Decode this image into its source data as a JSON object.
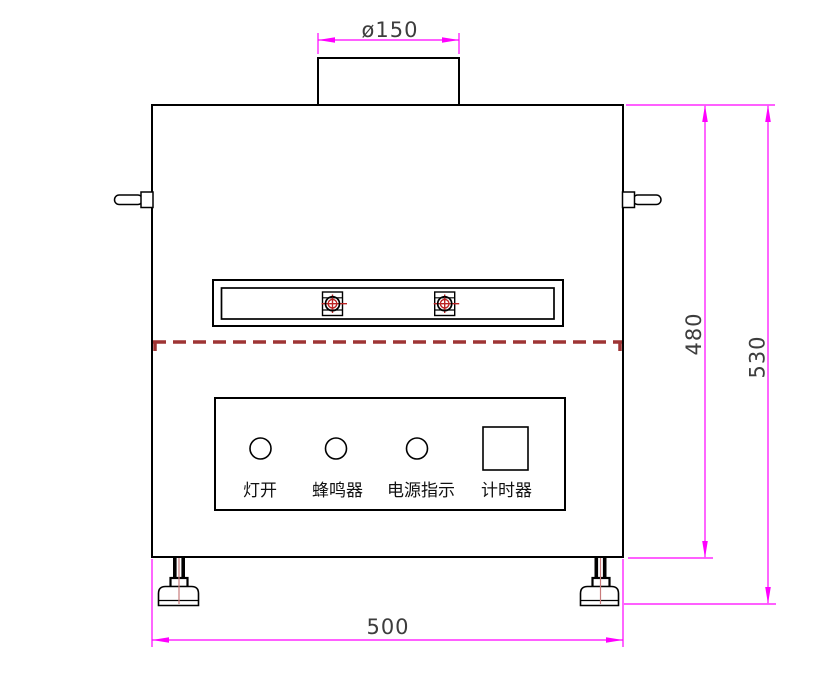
{
  "drawing": {
    "type": "engineering-front-view",
    "dimensions": {
      "vent_diameter": "ø150",
      "body_height": "480",
      "overall_height": "530",
      "body_width": "500"
    },
    "control_panel": {
      "controls": [
        {
          "shape": "circle",
          "label": "灯开"
        },
        {
          "shape": "circle",
          "label": "蜂鸣器"
        },
        {
          "shape": "circle",
          "label": "电源指示"
        },
        {
          "shape": "square",
          "label": "计时器"
        }
      ]
    },
    "colors": {
      "outline": "#000000",
      "dimension_line": "#ff00ff",
      "dimension_text": "#3d3d3d",
      "dashed_parting_line": "#9e3434",
      "screw_target": "#bb2222",
      "foot_centerline": "#c87b7b",
      "background": "#ffffff"
    }
  }
}
